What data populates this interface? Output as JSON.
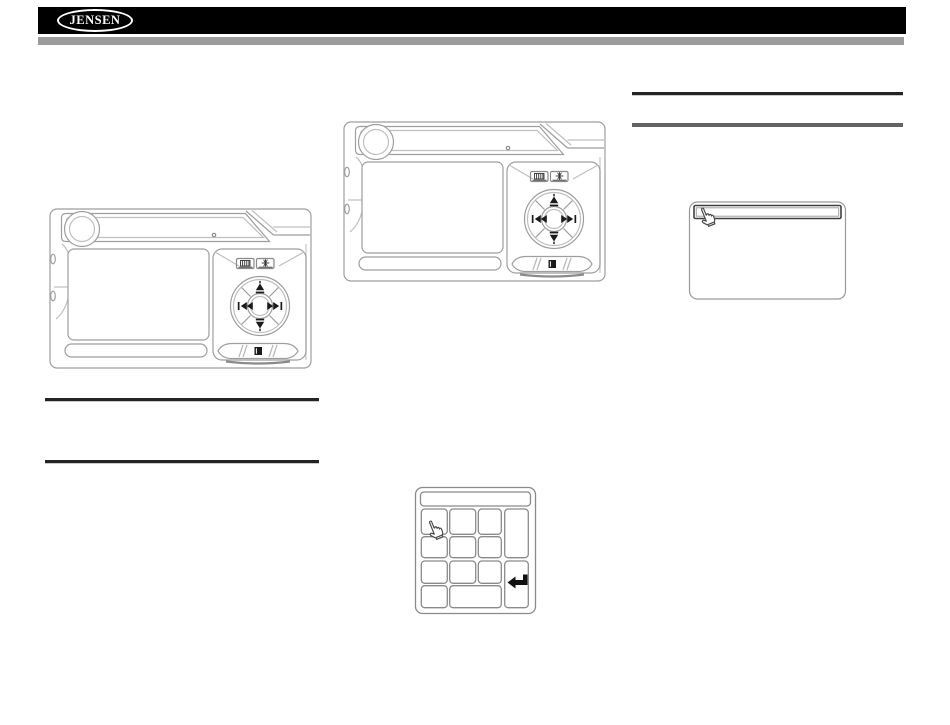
{
  "header": {
    "logo_text": "JENSEN",
    "bar_color": "#000000",
    "accent_bar_color": "#9c9c9c"
  },
  "rules": {
    "count": 4,
    "dark_color": "#242424",
    "gray_color": "#646464"
  },
  "figures": {
    "device_center": "dvd-player-front-view",
    "device_left": "dvd-player-front-view",
    "menu_screen": "screen-with-highlighted-top-bar-and-hand-cursor",
    "keypad": "numeric-keypad-with-hand-cursor-and-enter-key"
  },
  "icons": [
    "volume-knob",
    "power-led",
    "menu-icon",
    "setup-icon",
    "skip-up-icon",
    "skip-down-icon",
    "previous-track-icon",
    "next-track-icon",
    "eject-icon",
    "disc-slot",
    "hand-cursor-icon",
    "enter-arrow-icon"
  ],
  "line_art_color": "#9e9e9e"
}
